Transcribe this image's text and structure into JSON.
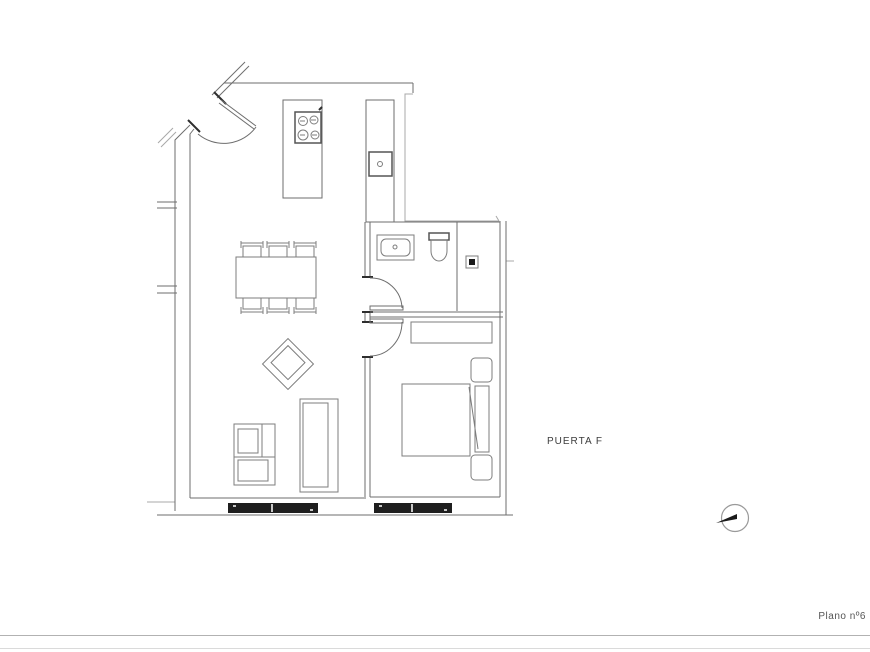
{
  "labels": {
    "puerta_f": "PUERTA F"
  },
  "footer": {
    "plano": "Plano nº6"
  },
  "icons": {
    "north_indicator": "north-arrow-icon"
  },
  "colors": {
    "background": "#ffffff",
    "wall_line": "#6e6e6e",
    "furniture_line": "#7d7d7d",
    "dark_marks": "#2e2e2e",
    "window_fill": "#1e1e1e",
    "label_text": "#3c3c3c",
    "footer_text": "#555555",
    "footer_rule": "#b2b2b2"
  }
}
